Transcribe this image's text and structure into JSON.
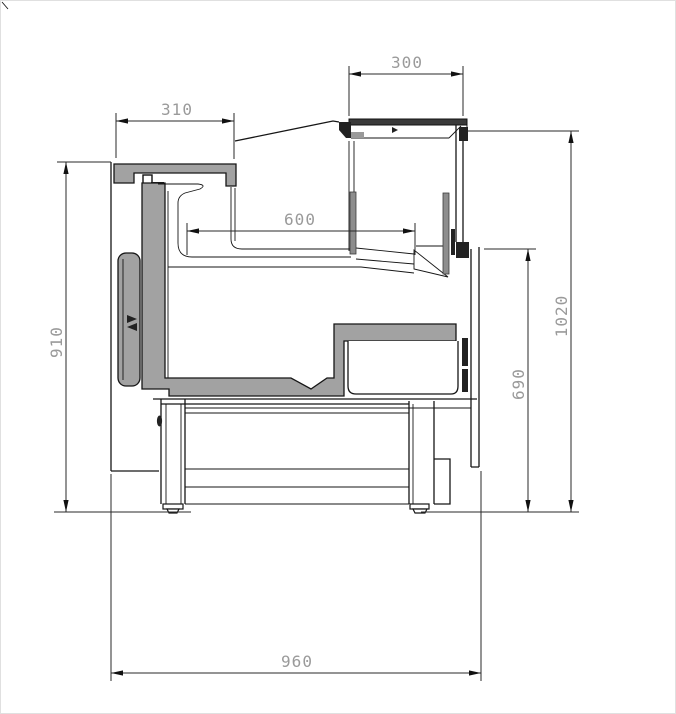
{
  "diagram": {
    "kind": "refrigerated-counter-cross-section",
    "dimension_labels": {
      "canopy_width": "300",
      "countertop_width": "310",
      "display_depth": "600",
      "front_height": "910",
      "overall_height": "1020",
      "rear_height": "690",
      "overall_depth": "960"
    },
    "colors": {
      "line": "#161616",
      "dimension_text": "#9a9a9a",
      "insulation_fill": "#a2a2a2",
      "panel_fill": "#8d8d8d",
      "canopy_top_fill": "#3a3a3a",
      "background": "#ffffff"
    }
  }
}
